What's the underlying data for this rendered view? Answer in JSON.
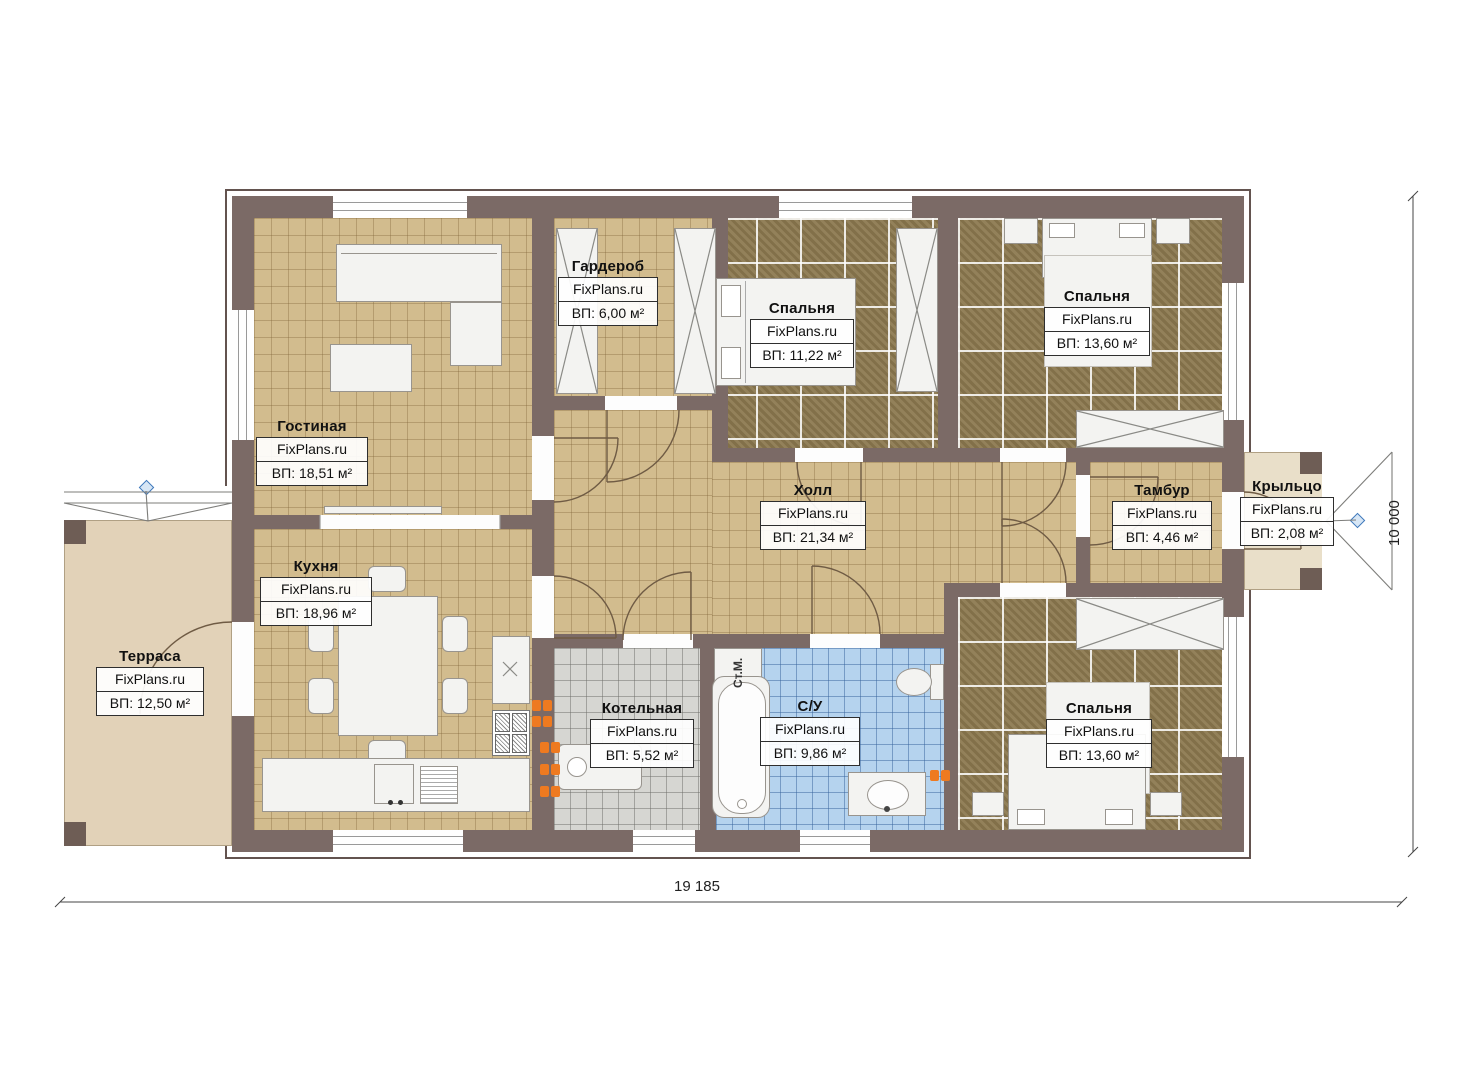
{
  "branding": "FixPlans.ru",
  "rooms": [
    {
      "id": "living",
      "name": "Гостиная",
      "site": "FixPlans.ru",
      "area": "ВП: 18,51 м²"
    },
    {
      "id": "kitchen",
      "name": "Кухня",
      "site": "FixPlans.ru",
      "area": "ВП: 18,96 м²"
    },
    {
      "id": "wardrobe",
      "name": "Гардероб",
      "site": "FixPlans.ru",
      "area": "ВП: 6,00 м²"
    },
    {
      "id": "bedroom-top-middle",
      "name": "Спальня",
      "site": "FixPlans.ru",
      "area": "ВП: 11,22 м²"
    },
    {
      "id": "bedroom-top-right",
      "name": "Спальня",
      "site": "FixPlans.ru",
      "area": "ВП: 13,60 м²"
    },
    {
      "id": "hall",
      "name": "Холл",
      "site": "FixPlans.ru",
      "area": "ВП: 21,34 м²"
    },
    {
      "id": "vestibule",
      "name": "Тамбур",
      "site": "FixPlans.ru",
      "area": "ВП: 4,46 м²"
    },
    {
      "id": "porch",
      "name": "Крыльцо",
      "site": "FixPlans.ru",
      "area": "ВП: 2,08 м²"
    },
    {
      "id": "terrace",
      "name": "Терраса",
      "site": "FixPlans.ru",
      "area": "ВП: 12,50 м²"
    },
    {
      "id": "boiler-room",
      "name": "Котельная",
      "site": "FixPlans.ru",
      "area": "ВП: 5,52 м²"
    },
    {
      "id": "bathroom",
      "name": "С/У",
      "site": "FixPlans.ru",
      "area": "ВП: 9,86 м²"
    },
    {
      "id": "bedroom-bottom-right",
      "name": "Спальня",
      "site": "FixPlans.ru",
      "area": "ВП: 13,60 м²"
    }
  ],
  "dimensions": {
    "bottom": "19 185",
    "right": "10 000"
  },
  "appliances": {
    "washing_machine": "Ст.М."
  },
  "colors": {
    "wall": "#7b6a66",
    "tile_beige": "#d2bc8e",
    "carpet": "#8c7950",
    "tile_blue": "#b5d3ee",
    "tile_gray": "#d6d6d2",
    "terrace": "#e2d2b8",
    "accent_orange": "#ee7a20",
    "accent_blue": "#3f78bb"
  }
}
